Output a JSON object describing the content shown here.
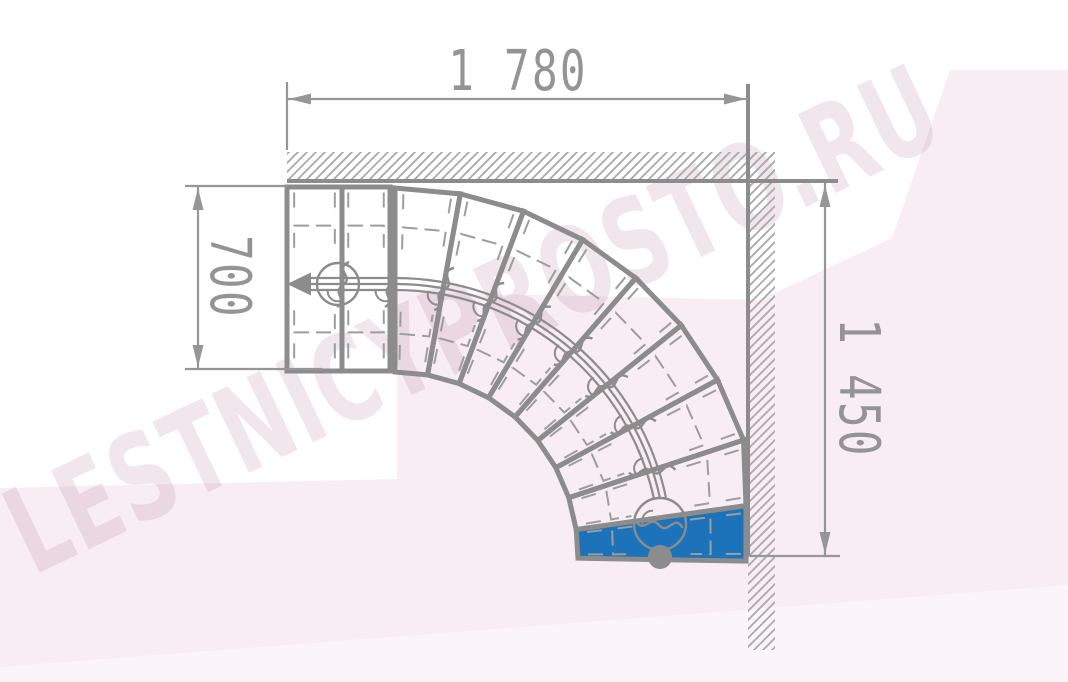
{
  "watermark": {
    "text": "LESTNICYPROSTO.RU"
  },
  "drawing": {
    "type": "staircase-floor-plan",
    "view": "top-plan",
    "dimensions": {
      "top": {
        "label": "1 780",
        "value_mm": 1780
      },
      "left": {
        "label": "700",
        "value_mm": 700
      },
      "right": {
        "label": "1 450",
        "value_mm": 1450
      }
    },
    "stairs": {
      "total_steps": 11,
      "straight_steps": 2,
      "winder_steps": 8,
      "turn": "quarter-turn-winder-90deg",
      "first_step_highlighted": true,
      "walk_line": {
        "start_marker": "dot",
        "end_marker": "arrow-left"
      }
    },
    "walls": [
      "top",
      "right"
    ]
  },
  "colors": {
    "accent_blue": "#1d73b9",
    "line_gray": "#8c8c8c",
    "detail_gray": "#9d9d9d",
    "dim_gray": "#969696",
    "hatch_gray": "#a9a9a9",
    "bg_pink": "#f8edf3",
    "bg_pink_light": "#fbf4f8",
    "watermark_color": "rgba(160,100,130,0.16)"
  }
}
